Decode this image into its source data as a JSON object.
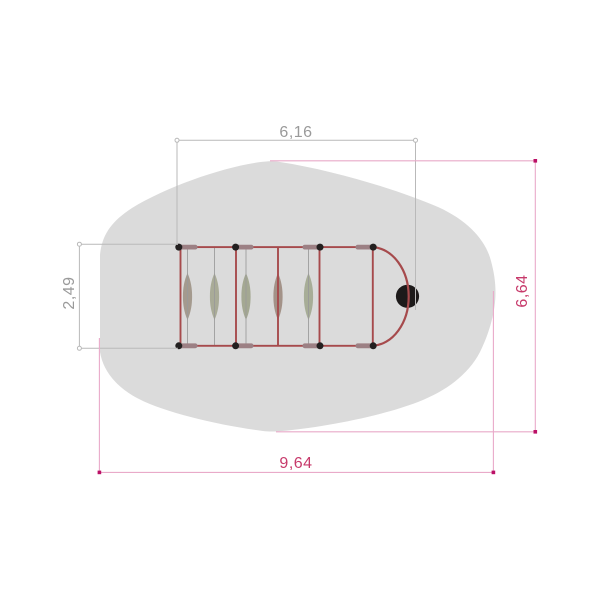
{
  "drawing": {
    "description": "Plan view of playground climbing equipment with safety zone",
    "dimension_labels": {
      "top_width": "6,16",
      "left_height": "2,49",
      "right_height": "6,64",
      "bottom_width": "9,64"
    },
    "colors": {
      "background": "#ffffff",
      "safety_zone": "#dbdbdb",
      "frame_red": "#a64a4c",
      "rope_gray": "#9a9a9a",
      "crossbar": "#9c8084",
      "joint_black": "#232020",
      "sphere_black": "#1d1a1a",
      "dim_gray_line": "#b9b9b9",
      "dim_gray_text": "#9a9a9a",
      "dim_magenta_line": "#e9aac9",
      "dim_magenta_marker": "#bb1066",
      "dim_magenta_text": "#c73a6b",
      "slats": [
        "#a49a8e",
        "#a9ab97",
        "#a4a892",
        "#a39288",
        "#a7ad97"
      ]
    }
  }
}
